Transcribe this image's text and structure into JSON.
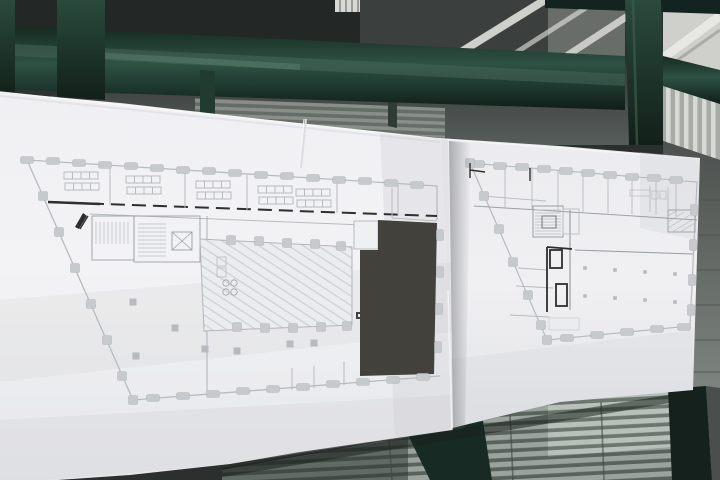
{
  "scene": {
    "setting": "photograph of two architectural floor-plan sheets displayed across a dark-green glazed partition",
    "objects": [
      "green window frame and mullions",
      "glass with ceiling and blind reflections",
      "left sheet: trapezoidal floor plan with hatched hall and dark filled block",
      "right sheet: trapezoidal floor plan with stair cores and open hall",
      "venetian blinds behind glazing"
    ],
    "visible_text": ""
  },
  "palette": {
    "frame_green": "#1e3a2f",
    "frame_green_dark": "#132420",
    "frame_green_light": "#3c5d4e",
    "frame_gloss": "#6e8d7d",
    "glass_dark": "#272b2a",
    "glass_mid": "#515755",
    "roof_dark": "#232726",
    "ceiling_light": "#cfd0cc",
    "ceiling_beam_white": "#e9eae5",
    "paper_bright": "#f3f3f5",
    "paper_base": "#ebebee",
    "paper_shade": "#dfe0e4",
    "plan_line_light": "#b7bbbf",
    "plan_line_mid": "#9aa0a4",
    "plan_line_dark": "#2e2e2e",
    "plan_fill_column": "#c6cacd",
    "plan_hall_fill": "#eaecee",
    "plan_dark_block": "#42413c",
    "blind_slat": "#9aa39d",
    "blind_gap": "#58635c",
    "blind_bright": "#b9c2ba",
    "shadow_under_paper": "#1c201e"
  }
}
